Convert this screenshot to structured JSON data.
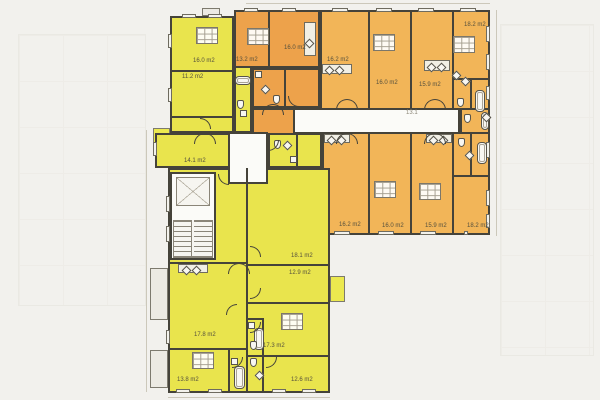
{
  "document": {
    "type": "residential floor plan drawing"
  },
  "colors": {
    "background": "#f2f1ed",
    "apartment_yellow": "#e9e44d",
    "apartment_orange_dark": "#eda24b",
    "apartment_orange_light": "#f2b558",
    "common_area_white": "#fbfbf8",
    "wall": "#45433a"
  },
  "corridor_label": {
    "text": "13.1",
    "pos": [
      406,
      110
    ]
  },
  "plan": {
    "blocks": [
      {
        "name": "balcony-top",
        "color": "grayBal",
        "rect": [
          202,
          8,
          18,
          8
        ]
      },
      {
        "name": "balcony-left-upper",
        "color": "yellowBal",
        "rect": [
          153,
          128,
          17,
          28
        ]
      },
      {
        "name": "balcony-left-mid",
        "color": "grayBal",
        "rect": [
          150,
          268,
          18,
          52
        ]
      },
      {
        "name": "balcony-left-lower",
        "color": "grayBal",
        "rect": [
          150,
          350,
          18,
          38
        ]
      },
      {
        "name": "balcony-right-bump",
        "color": "yellowBal",
        "rect": [
          330,
          276,
          15,
          26
        ]
      },
      {
        "name": "apartment-yellow-topleft",
        "color": "yellow",
        "rect": [
          170,
          16,
          64,
          117
        ]
      },
      {
        "name": "apartment-yellow-bath-pocket",
        "color": "yellow",
        "rect": [
          234,
          65,
          18,
          68
        ]
      },
      {
        "name": "room-14-1",
        "color": "yellow",
        "rect": [
          155,
          133,
          91,
          35
        ]
      },
      {
        "name": "orange-apartment-west-upper",
        "color": "orangeDeep",
        "rect": [
          234,
          10,
          86,
          58
        ]
      },
      {
        "name": "orange-apartment-west-bath",
        "color": "orangeDeep",
        "rect": [
          252,
          68,
          68,
          40
        ]
      },
      {
        "name": "orange-apartment-west-hall",
        "color": "orangeDeep",
        "rect": [
          252,
          108,
          43,
          27
        ]
      },
      {
        "name": "orange-rooms-top-row",
        "color": "orangeLight",
        "rect": [
          320,
          10,
          170,
          100
        ]
      },
      {
        "name": "orange-bath-cell-east",
        "color": "orangeLight",
        "rect": [
          460,
          108,
          30,
          27
        ]
      },
      {
        "name": "orange-rooms-bottom-row",
        "color": "orangeLight",
        "rect": [
          322,
          132,
          168,
          103
        ]
      },
      {
        "name": "yellow-entry-room",
        "color": "yellow",
        "rect": [
          268,
          133,
          54,
          35
        ]
      },
      {
        "name": "yellow-lower-apartment",
        "color": "yellow",
        "rect": [
          168,
          168,
          162,
          225
        ]
      },
      {
        "name": "corridor",
        "color": "white corridor",
        "rect": [
          295,
          108,
          165,
          26
        ]
      },
      {
        "name": "lobby",
        "color": "white",
        "rect": [
          228,
          132,
          40,
          52
        ]
      },
      {
        "name": "stairwell",
        "color": "white",
        "rect": [
          170,
          172,
          46,
          88
        ]
      }
    ],
    "walls": [
      [
        170,
        70,
        64,
        2
      ],
      [
        170,
        116,
        64,
        2
      ],
      [
        268,
        10,
        2,
        58
      ],
      [
        284,
        68,
        2,
        40
      ],
      [
        368,
        10,
        2,
        100
      ],
      [
        410,
        10,
        2,
        100
      ],
      [
        452,
        10,
        2,
        100
      ],
      [
        452,
        78,
        38,
        2
      ],
      [
        470,
        78,
        2,
        30
      ],
      [
        368,
        132,
        2,
        103
      ],
      [
        410,
        132,
        2,
        103
      ],
      [
        452,
        132,
        2,
        103
      ],
      [
        452,
        175,
        38,
        2
      ],
      [
        470,
        132,
        2,
        45
      ],
      [
        296,
        133,
        2,
        35
      ],
      [
        246,
        168,
        2,
        225
      ],
      [
        246,
        264,
        84,
        2
      ],
      [
        246,
        302,
        84,
        2
      ],
      [
        246,
        355,
        84,
        2
      ],
      [
        168,
        262,
        78,
        2
      ],
      [
        168,
        348,
        78,
        2
      ],
      [
        228,
        348,
        2,
        45
      ],
      [
        262,
        355,
        2,
        38
      ],
      [
        262,
        318,
        2,
        37
      ],
      [
        246,
        318,
        16,
        2
      ]
    ],
    "windows": [
      [
        182,
        14,
        14,
        4
      ],
      [
        208,
        14,
        14,
        4
      ],
      [
        244,
        8,
        14,
        4
      ],
      [
        282,
        8,
        14,
        4
      ],
      [
        332,
        8,
        16,
        4
      ],
      [
        376,
        8,
        16,
        4
      ],
      [
        418,
        8,
        16,
        4
      ],
      [
        460,
        8,
        16,
        4
      ],
      [
        486,
        26,
        4,
        16
      ],
      [
        486,
        54,
        4,
        16
      ],
      [
        486,
        86,
        4,
        14
      ],
      [
        486,
        142,
        4,
        16
      ],
      [
        486,
        190,
        4,
        16
      ],
      [
        486,
        214,
        4,
        14
      ],
      [
        334,
        231,
        16,
        4
      ],
      [
        378,
        231,
        16,
        4
      ],
      [
        420,
        231,
        16,
        4
      ],
      [
        464,
        231,
        4,
        4
      ],
      [
        176,
        389,
        14,
        4
      ],
      [
        208,
        389,
        14,
        4
      ],
      [
        272,
        389,
        14,
        4
      ],
      [
        302,
        389,
        14,
        4
      ],
      [
        166,
        196,
        4,
        16
      ],
      [
        166,
        226,
        4,
        16
      ],
      [
        166,
        330,
        4,
        14
      ],
      [
        168,
        34,
        4,
        14
      ],
      [
        168,
        88,
        4,
        14
      ],
      [
        153,
        142,
        4,
        14
      ]
    ],
    "doors": {
      "bowties": [
        [
          336,
          99
        ],
        [
          424,
          99
        ],
        [
          336,
          133
        ],
        [
          424,
          133
        ],
        [
          262,
          104
        ],
        [
          194,
          133
        ],
        [
          228,
          263
        ]
      ],
      "arcs": [
        [
          218,
          174,
          "sw"
        ],
        [
          268,
          140,
          "se"
        ],
        [
          250,
          246,
          "ne"
        ],
        [
          250,
          288,
          "se"
        ],
        [
          226,
          304,
          "nw"
        ],
        [
          250,
          322,
          "se"
        ],
        [
          232,
          357,
          "se"
        ],
        [
          266,
          357,
          "se"
        ],
        [
          200,
          118,
          "ne"
        ],
        [
          288,
          96,
          "sw"
        ]
      ]
    },
    "fixtures": {
      "tubs": [
        [
          235,
          76,
          16,
          9
        ],
        [
          475,
          90,
          10,
          22
        ],
        [
          481,
          112,
          8,
          18
        ],
        [
          477,
          142,
          10,
          22
        ],
        [
          254,
          328,
          10,
          22
        ],
        [
          234,
          366,
          11,
          23
        ]
      ],
      "toilets": [
        [
          237,
          100
        ],
        [
          273,
          95
        ],
        [
          457,
          98
        ],
        [
          464,
          114
        ],
        [
          458,
          138
        ],
        [
          250,
          341
        ],
        [
          250,
          358
        ],
        [
          274,
          140
        ]
      ],
      "sinks": [
        [
          326,
          67
        ],
        [
          336,
          67
        ],
        [
          428,
          64
        ],
        [
          438,
          64
        ],
        [
          453,
          72
        ],
        [
          462,
          78
        ],
        [
          328,
          137
        ],
        [
          338,
          137
        ],
        [
          430,
          137
        ],
        [
          440,
          137
        ],
        [
          183,
          267
        ],
        [
          193,
          267
        ],
        [
          306,
          40
        ],
        [
          262,
          86
        ],
        [
          483,
          114
        ],
        [
          466,
          152
        ],
        [
          256,
          372
        ],
        [
          284,
          142
        ]
      ],
      "counters": [
        [
          322,
          64,
          30,
          10
        ],
        [
          424,
          60,
          26,
          11
        ],
        [
          324,
          134,
          26,
          9
        ],
        [
          426,
          134,
          26,
          9
        ],
        [
          178,
          264,
          30,
          9
        ],
        [
          304,
          22,
          12,
          34
        ]
      ],
      "washers": [
        [
          255,
          71
        ],
        [
          240,
          110
        ],
        [
          248,
          322
        ],
        [
          231,
          358
        ],
        [
          290,
          156
        ]
      ]
    },
    "stamps": [
      [
        196,
        27
      ],
      [
        247,
        28
      ],
      [
        373,
        34
      ],
      [
        453,
        36
      ],
      [
        374,
        181
      ],
      [
        419,
        183
      ],
      [
        281,
        313
      ],
      [
        192,
        352
      ]
    ],
    "room_labels": [
      {
        "text": "16.0 m2",
        "pos": [
          193,
          58
        ]
      },
      {
        "text": "11.2 m2",
        "pos": [
          182,
          74
        ]
      },
      {
        "text": "14.1 m2",
        "pos": [
          184,
          158
        ]
      },
      {
        "text": "13.2 m2",
        "pos": [
          236,
          57
        ]
      },
      {
        "text": "16.0 m2",
        "pos": [
          284,
          45
        ]
      },
      {
        "text": "16.2 m2",
        "pos": [
          327,
          57
        ]
      },
      {
        "text": "16.0 m2",
        "pos": [
          376,
          80
        ]
      },
      {
        "text": "15.9 m2",
        "pos": [
          419,
          82
        ]
      },
      {
        "text": "18.2 m2",
        "pos": [
          464,
          22
        ]
      },
      {
        "text": "16.2 m2",
        "pos": [
          339,
          222
        ]
      },
      {
        "text": "16.0 m2",
        "pos": [
          382,
          223
        ]
      },
      {
        "text": "15.9 m2",
        "pos": [
          425,
          223
        ]
      },
      {
        "text": "18.2 m2",
        "pos": [
          467,
          223
        ]
      },
      {
        "text": "18.1 m2",
        "pos": [
          291,
          253
        ]
      },
      {
        "text": "12.9 m2",
        "pos": [
          289,
          270
        ]
      },
      {
        "text": "17.8 m2",
        "pos": [
          194,
          332
        ]
      },
      {
        "text": "17.3 m2",
        "pos": [
          263,
          343
        ]
      },
      {
        "text": "13.8 m2",
        "pos": [
          177,
          377
        ]
      },
      {
        "text": "12.6 m2",
        "pos": [
          291,
          377
        ]
      }
    ]
  }
}
